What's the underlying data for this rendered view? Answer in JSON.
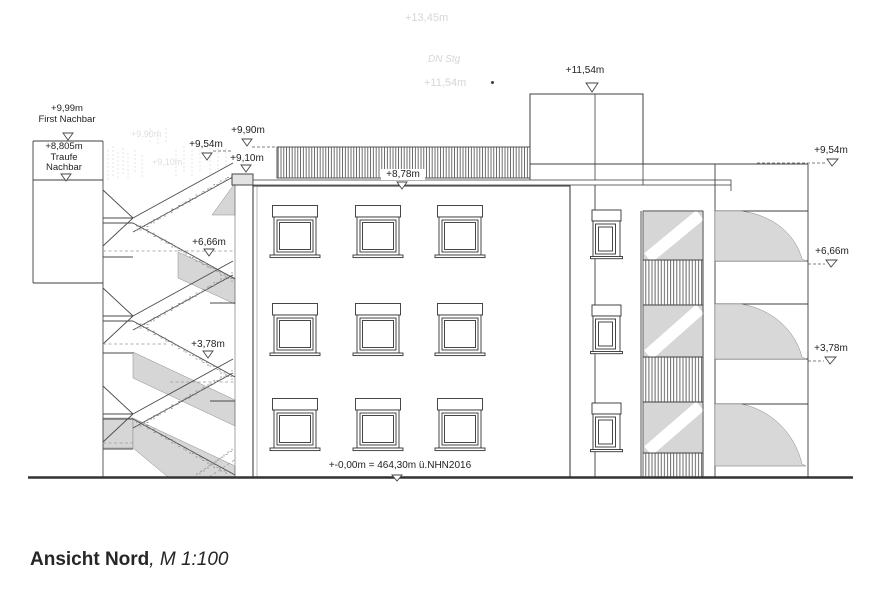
{
  "title": {
    "main": "Ansicht Nord",
    "scale": ", M 1:100"
  },
  "labels": {
    "neighbor_ridge_value": "+9,99m",
    "neighbor_ridge_name": "First Nachbar",
    "neighbor_eaves_value": "+8,805m",
    "neighbor_eaves_name1": "Traufe",
    "neighbor_eaves_name2": "Nachbar",
    "stair_954": "+9,54m",
    "roof_990": "+9,90m",
    "parapet_910": "+9,10m",
    "stair_666": "+6,66m",
    "stair_378": "+3,78m",
    "roofband_878": "+8,78m",
    "tower_1154": "+11,54m",
    "right_954": "+9,54m",
    "right_666": "+6,66m",
    "right_378": "+3,78m",
    "ground_level": "+-0,00m = 464,30m ü.NHN2016"
  },
  "ghost_text": {
    "g1": "+13,45m",
    "g2": "DN Stg",
    "g3": "+11,54m",
    "g4": "+9,90m",
    "g5": "+9,10m"
  },
  "colors": {
    "line": "#3f3f3f",
    "gray_fill": "#d6d6d6",
    "hatch": "#4a4a4a",
    "ghost": "#d6d6d6",
    "ground": "#333333"
  }
}
